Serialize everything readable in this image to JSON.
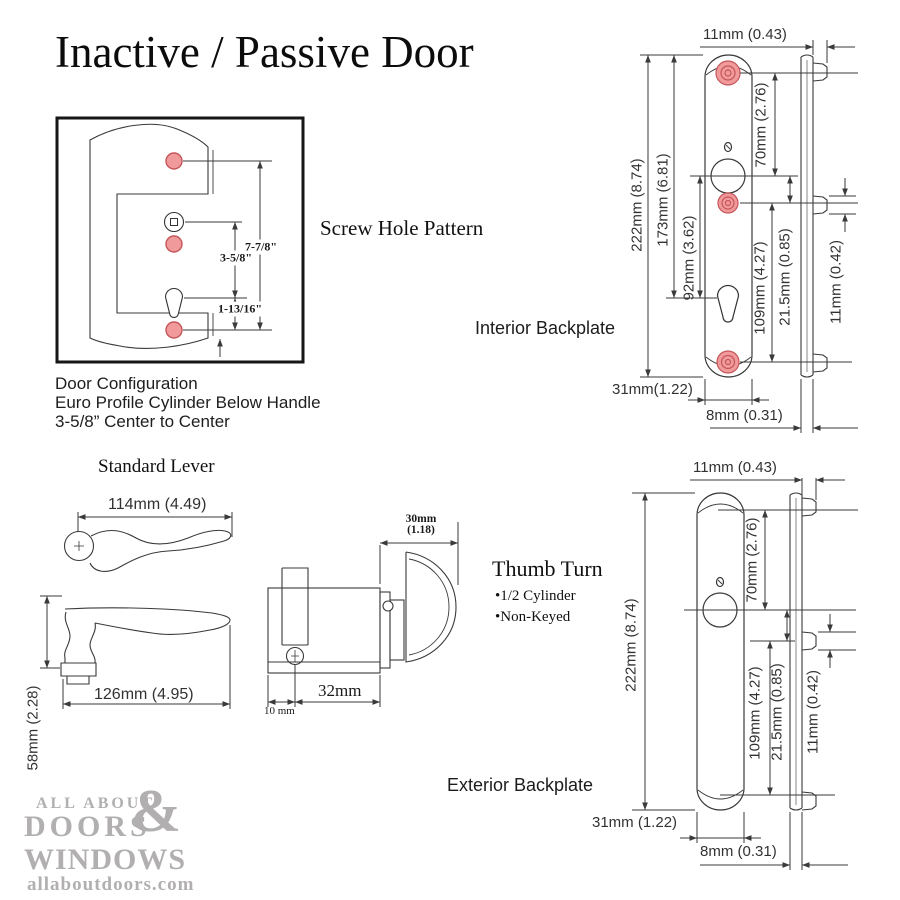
{
  "title": "Inactive / Passive Door",
  "screw_pattern": {
    "heading": "Screw Hole Pattern",
    "dim_total": "7-7/8\"",
    "dim_center": "3-5/8\"",
    "dim_bottom": "1-13/16\"",
    "caption1": "Door Configuration",
    "caption2": "Euro Profile Cylinder Below Handle",
    "caption3": "3-5/8” Center to Center"
  },
  "interior": {
    "heading": "Interior Backplate",
    "tab_depth": "11mm (0.43)",
    "total_height": "222mm (8.74)",
    "top_to_cylinder": "173mm (6.81)",
    "handle_to_cylinder": "92mm (3.62)",
    "screw_to_handle": "70mm (2.76)",
    "handle_to_bottom": "109mm (4.27)",
    "handle_offset": "21.5mm (0.85)",
    "tab_height": "11mm (0.42)",
    "plate_width": "31mm(1.22)",
    "plate_depth": "8mm (0.31)"
  },
  "exterior": {
    "heading": "Exterior Backplate",
    "tab_depth": "11mm (0.43)",
    "total_height": "222mm (8.74)",
    "post_to_center": "70mm (2.76)",
    "center_to_bottom": "109mm (4.27)",
    "center_offset": "21.5mm (0.85)",
    "tab_height": "11mm (0.42)",
    "plate_width": "31mm (1.22)",
    "plate_depth": "8mm (0.31)"
  },
  "lever": {
    "heading": "Standard Lever",
    "top_width": "114mm (4.49)",
    "side_length": "126mm (4.95)",
    "side_height": "58mm (2.28)"
  },
  "cylinder": {
    "heading": "Thumb Turn",
    "bullet1": "•1/2 Cylinder",
    "bullet2": "•Non-Keyed",
    "turn_depth_l1": "30mm",
    "turn_depth_l2": "(1.18)",
    "body_length": "32mm",
    "edge_offset": "10 mm"
  },
  "logo": {
    "line1": "ALL ABOUT",
    "amp": "&",
    "line2": "DOORS",
    "line3": "WINDOWS",
    "site": "allaboutdoors.com"
  },
  "colors": {
    "line": "#3a3a3a",
    "screw_fill": "#f19a9c",
    "screw_ring": "#c4565a",
    "logo_gray": "#b1afaf"
  }
}
